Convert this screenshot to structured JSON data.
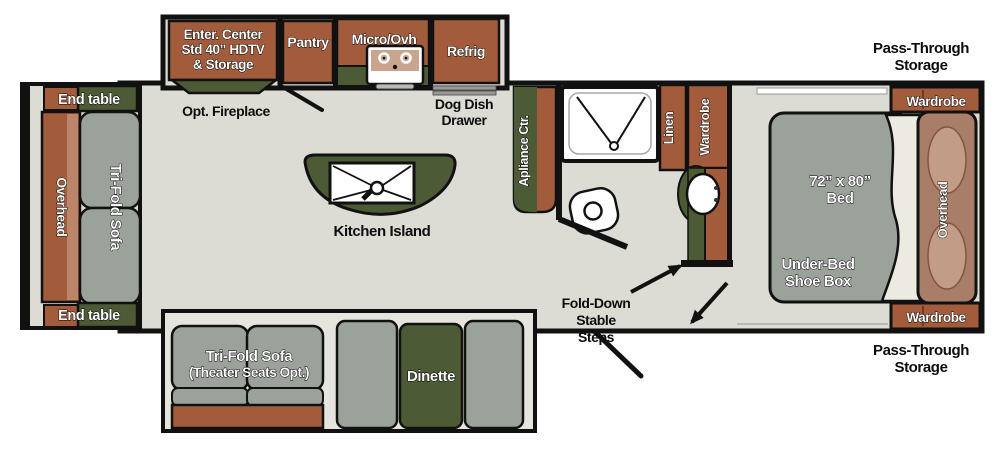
{
  "floorplan": {
    "title_hint": "RV travel trailer floor plan",
    "left_slide": {
      "end_table_top": "End table",
      "end_table_bottom": "End table",
      "overhead": "Overhead",
      "sofa": "Tri-Fold Sofa"
    },
    "top_slide": {
      "ent_center_line1": "Enter. Center",
      "ent_center_line2": "Std 40” HDTV",
      "ent_center_line3": "& Storage",
      "pantry": "Pantry",
      "micro": "Micro/Ovh",
      "refrig": "Refrig"
    },
    "kitchen": {
      "opt_fireplace": "Opt. Fireplace",
      "dog_dish_line1": "Dog Dish",
      "dog_dish_line2": "Drawer",
      "island": "Kitchen Island",
      "appliance": "Apliance Ctr."
    },
    "bath": {
      "linen": "Linen",
      "wardrobe": "Wardrobe"
    },
    "entry": {
      "steps_line1": "Fold-Down",
      "steps_line2": "Stable",
      "steps_line3": "Steps"
    },
    "bedroom": {
      "bed_line1": "72” x 80”",
      "bed_line2": "Bed",
      "underbed_line1": "Under-Bed",
      "underbed_line2": "Shoe Box",
      "overhead": "Overhead",
      "wardrobe_top": "Wardrobe",
      "wardrobe_bottom": "Wardrobe",
      "pass_through_top_line1": "Pass-Through",
      "pass_through_top_line2": "Storage",
      "pass_through_bottom_line1": "Pass-Through",
      "pass_through_bottom_line2": "Storage"
    },
    "bottom_slide": {
      "sofa_line1": "Tri-Fold Sofa",
      "sofa_line2": "(Theater Seats Opt.)",
      "dinette": "Dinette"
    }
  },
  "colors": {
    "cabinet_brown": "#A35C3B",
    "cabinet_brown_light": "#BA8568",
    "olive_green": "#4C5A36",
    "furniture_gray": "#9BA29A",
    "floor": "#DCDCD4",
    "slide_floor": "#E5E5DD",
    "headboard_brown": "#A87E68",
    "pillow_tan": "#C29C86",
    "range_tan": "#C9A58E",
    "wall_black": "#111111"
  }
}
